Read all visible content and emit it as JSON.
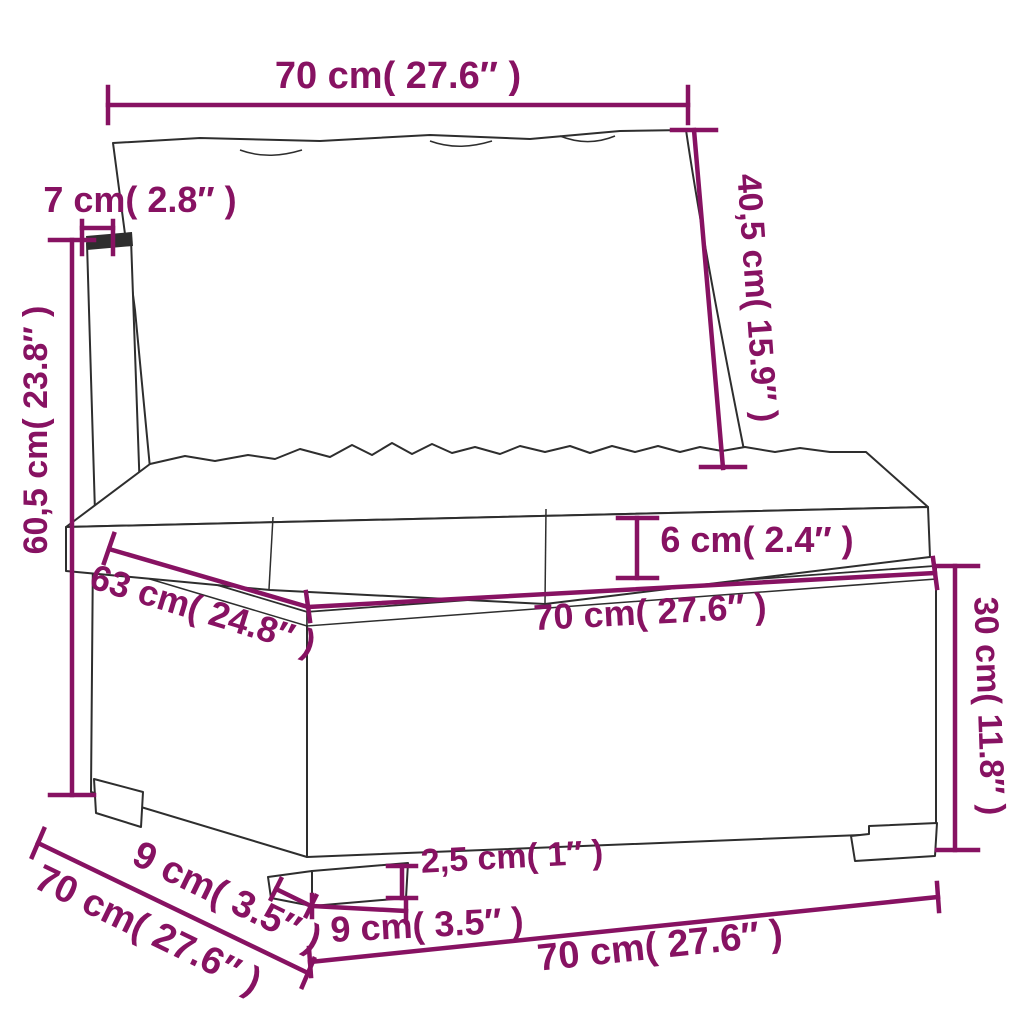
{
  "diagram": {
    "type": "product-dimension-diagram",
    "product": "poly-rattan garden sofa middle section with cushions",
    "accent_color": "#871262",
    "line_color": "#2e2e2e",
    "background": "#ffffff",
    "labels": {
      "top_width": "70 cm( 27.6″  )",
      "backrest_thickness": "7 cm( 2.8″  )",
      "back_cushion_height": "40,5 cm( 15.9″  )",
      "total_height": "60,5 cm( 23.8″  )",
      "seat_cushion_thickness": "6 cm( 2.4″  )",
      "seat_depth": "63 cm( 24.8″  )",
      "seat_width": "70 cm( 27.6″  )",
      "base_height": "30 cm( 11.8″  )",
      "side_leg_width": "9 cm( 3.5″  )",
      "side_depth": "70 cm( 27.6″  )",
      "leg_height": "2,5 cm( 1″  )",
      "front_leg_width": "9 cm( 3.5″  )",
      "bottom_width": "70 cm( 27.6″  )"
    }
  }
}
